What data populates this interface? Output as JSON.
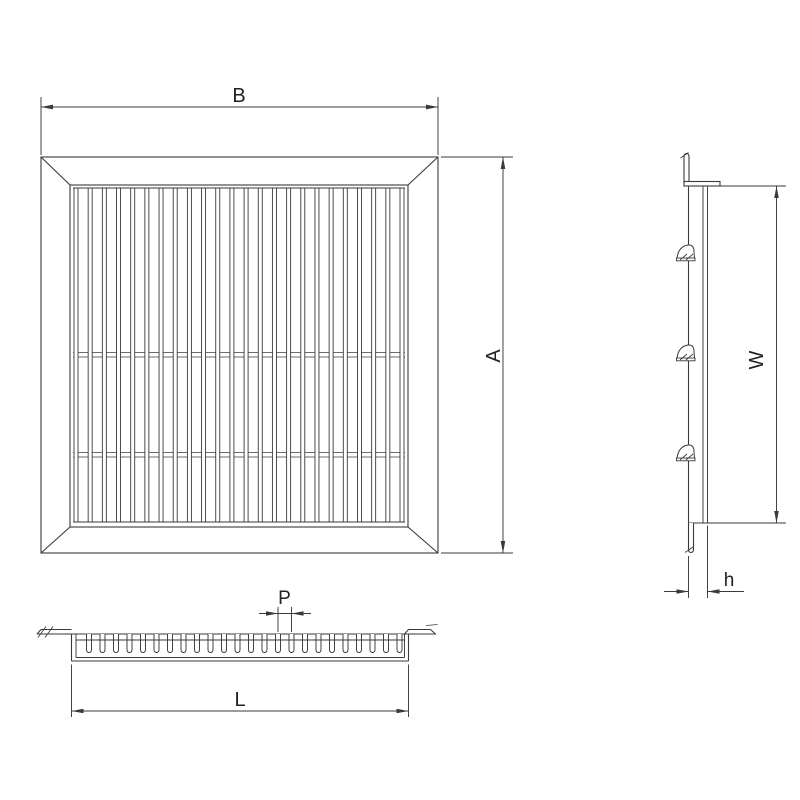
{
  "drawing": {
    "kind": "technical-drawing-grille",
    "colors": {
      "background": "#ffffff",
      "line": "#3a3a3a",
      "text": "#222222"
    },
    "front_view": {
      "name": "front-view",
      "dim_width_label": "B",
      "dim_height_label": "A",
      "slat_count": 24,
      "tie_rod_rows": 2
    },
    "side_view": {
      "name": "side-view",
      "dim_height_label": "W",
      "dim_depth_label": "h",
      "clip_count": 3
    },
    "bottom_view": {
      "name": "bottom-section-view",
      "dim_pitch_label": "P",
      "dim_length_label": "L",
      "tooth_count": 24
    }
  }
}
